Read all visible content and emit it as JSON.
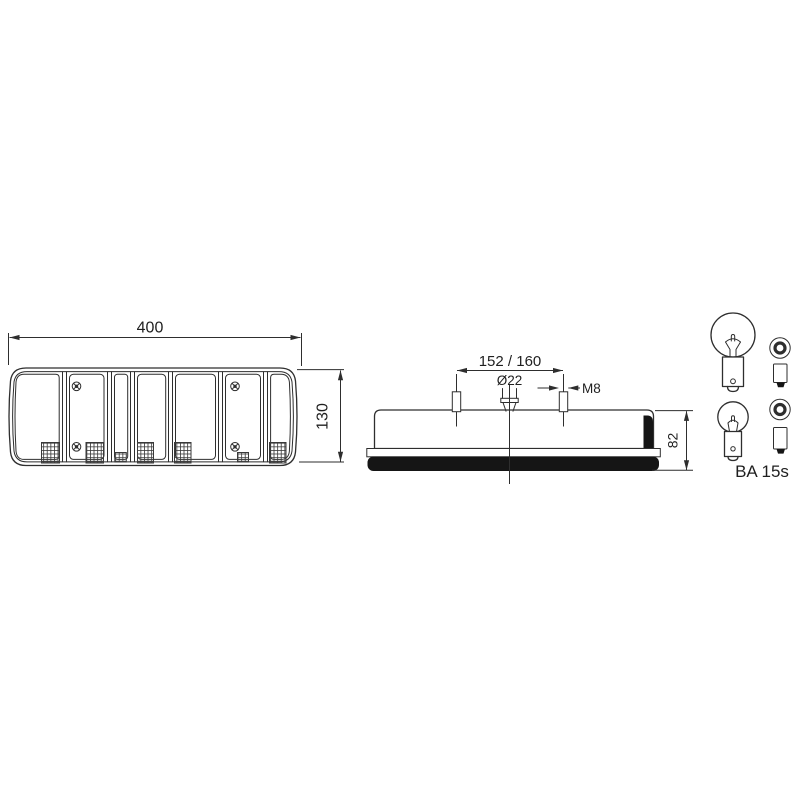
{
  "diagram": {
    "colors": {
      "background": "#ffffff",
      "line": "#2e2e2e",
      "solid_fill": "#151515"
    },
    "labels": {
      "front_width": "400",
      "front_height": "130",
      "stud_spacing": "152 / 160",
      "connector_diameter": "Ø22",
      "stud_thread": "M8",
      "side_height": "82",
      "bulb_socket": "BA 15s"
    }
  }
}
